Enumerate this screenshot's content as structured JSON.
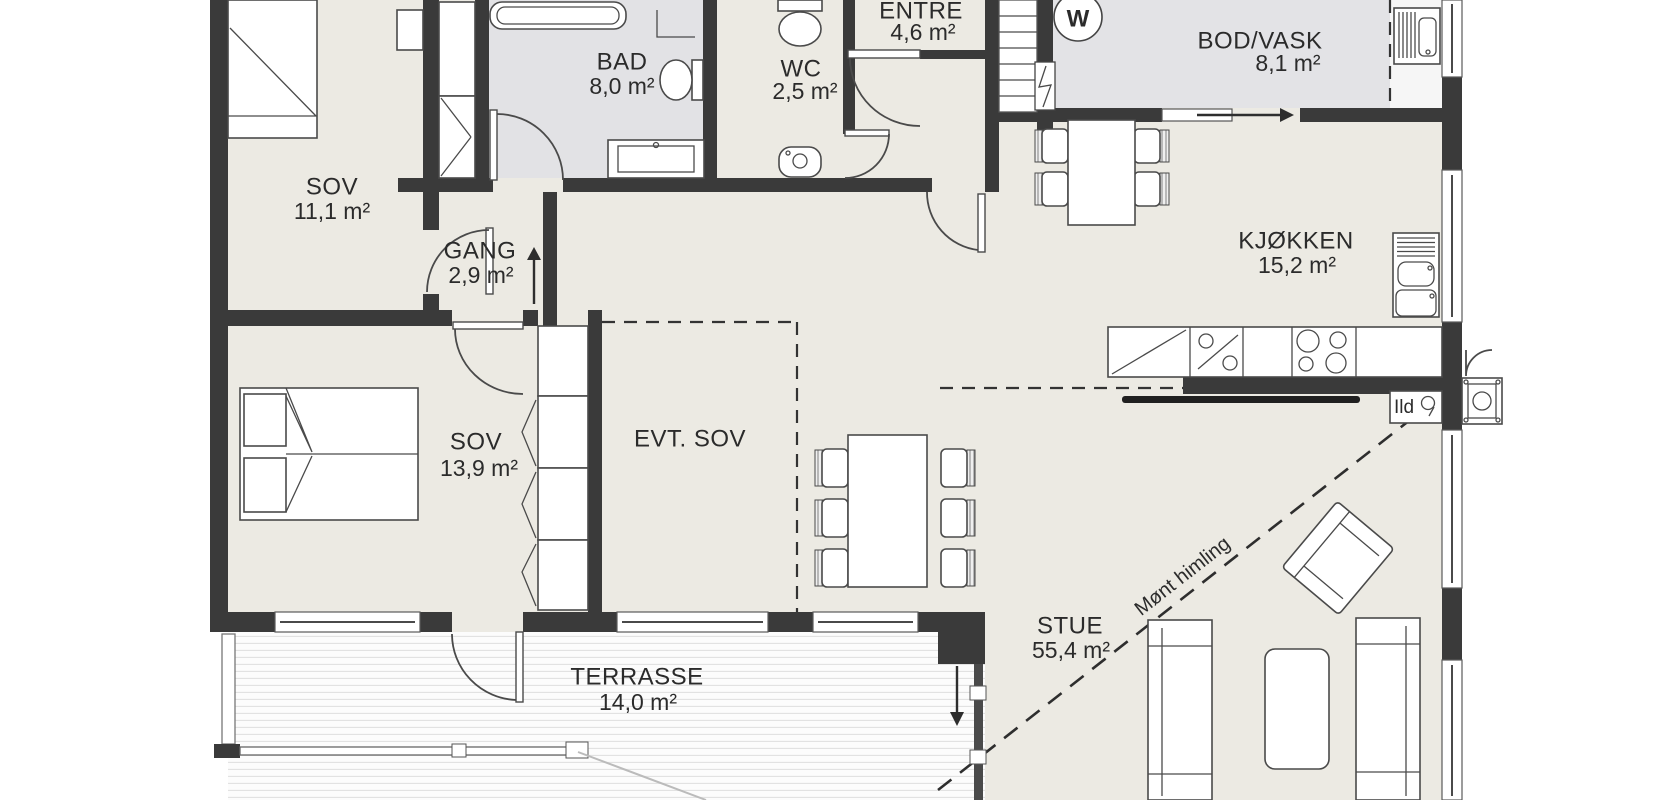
{
  "rooms": [
    {
      "name": "SOV",
      "area": "11,1 m²"
    },
    {
      "name": "BAD",
      "area": "8,0 m²"
    },
    {
      "name": "WC",
      "area": "2,5 m²"
    },
    {
      "name": "ENTRE",
      "area": "4,6 m²"
    },
    {
      "name": "BOD/VASK",
      "area": "8,1 m²"
    },
    {
      "name": "GANG",
      "area": "2,9 m²"
    },
    {
      "name": "KJØKKEN",
      "area": "15,2 m²"
    },
    {
      "name": "SOV",
      "area": "13,9 m²"
    },
    {
      "name": "EVT. SOV",
      "area": ""
    },
    {
      "name": "STUE",
      "area": "55,4 m²"
    },
    {
      "name": "TERRASSE",
      "area": "14,0 m²"
    }
  ],
  "annotations": {
    "ridge_ceiling": "Mønt himling",
    "fireplace": "Ild",
    "washing_machine": "W"
  },
  "colors": {
    "floor": "#ECEAE3",
    "wet_room_floor": "#E2E2E5",
    "wall": "#3A3A3A",
    "background": "#FFFFFF"
  }
}
